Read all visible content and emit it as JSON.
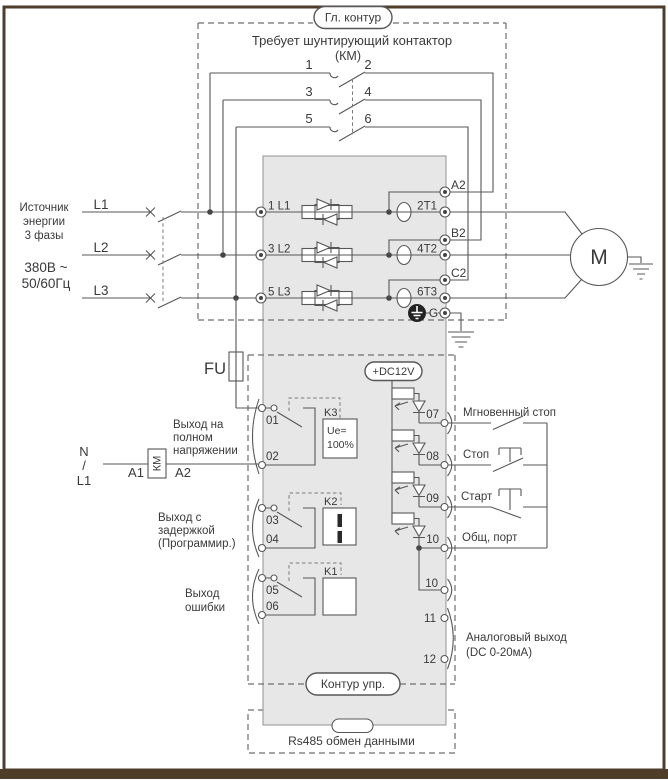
{
  "frame": {
    "border_color": "#4e3d28"
  },
  "main_circuit": {
    "pill": "Гл. контур",
    "note1": "Требует шунтирующий контактор",
    "note2": "(КМ)",
    "contact_numbers": [
      "1",
      "2",
      "3",
      "4",
      "5",
      "6"
    ]
  },
  "source": {
    "lines": [
      "Источник",
      "энергии",
      "3 фазы"
    ],
    "voltage": "380В ~",
    "frequency": "50/60Гц",
    "phases": [
      "L1",
      "L2",
      "L3"
    ]
  },
  "power": {
    "inputs": [
      "1 L1",
      "3 L2",
      "5 L3"
    ],
    "outputs": [
      "2T1",
      "4T2",
      "6T3"
    ],
    "bypass": [
      "A2",
      "B2",
      "C2"
    ],
    "ground": "G",
    "motor": "M"
  },
  "fuse": "FU",
  "km": {
    "neutral": "N",
    "slash": "/",
    "line": "L1",
    "a1": "A1",
    "coil": "КМ",
    "a2": "A2"
  },
  "control": {
    "dc12v": "+DC12V",
    "outputs": [
      {
        "lines": [
          "Выход на",
          "полном",
          "напряжении"
        ],
        "t1": "01",
        "t2": "02",
        "relay": "K3",
        "note1": "Ue=",
        "note2": "100%"
      },
      {
        "lines": [
          "Выход с",
          "задержкой",
          "(Программир.)"
        ],
        "t1": "03",
        "t2": "04",
        "relay": "K2"
      },
      {
        "lines": [
          "Выход",
          "ошибки"
        ],
        "t1": "05",
        "t2": "06",
        "relay": "K1"
      }
    ],
    "inputs": [
      {
        "t": "07",
        "label": "Мгновенный стоп"
      },
      {
        "t": "08",
        "label": "Стоп"
      },
      {
        "t": "09",
        "label": "Старт"
      },
      {
        "t": "10",
        "label": "Общ, порт"
      }
    ],
    "t10b": "10",
    "analog": {
      "t1": "11",
      "t2": "12",
      "label1": "Аналоговый выход",
      "label2": "(DC 0-20мА)"
    },
    "pill": "Контур упр."
  },
  "rs485": {
    "label": "Rs485 обмен данными"
  }
}
